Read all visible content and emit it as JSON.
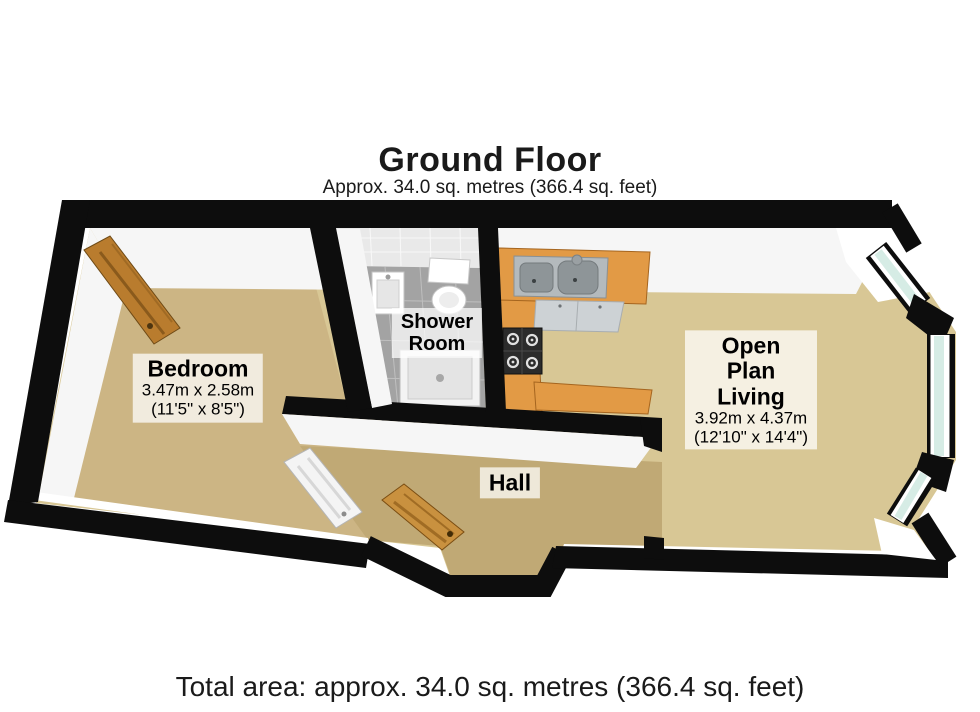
{
  "header": {
    "title": "Ground Floor",
    "subtitle": "Approx. 34.0 sq. metres (366.4 sq. feet)"
  },
  "footer": {
    "total_area": "Total area: approx. 34.0 sq. metres (366.4 sq. feet)"
  },
  "rooms": {
    "bedroom": {
      "name": "Bedroom",
      "metric": "3.47m x 2.58m",
      "imperial": "(11'5\" x 8'5\")"
    },
    "shower_room": {
      "line1": "Shower",
      "line2": "Room"
    },
    "hall": {
      "name": "Hall"
    },
    "open_plan_living": {
      "line1": "Open",
      "line2": "Plan",
      "line3": "Living",
      "metric": "3.92m x 4.37m",
      "imperial": "(12'10\" x 14'4\")"
    }
  },
  "colors": {
    "wall": "#0d0d0d",
    "floor_bedroom": "#ccb584",
    "floor_hall": "#c0a975",
    "floor_living": "#d8c795",
    "floor_shower": "#a3a3a3",
    "shower_wall_tile": "#e9e9e9",
    "counter": "#e29a45",
    "cabinet": "#cdd2d5",
    "sink_steel": "#b4babd",
    "basin": "#8e9598",
    "hob": "#2b2b2b",
    "glass": "#d6ece5",
    "door_wood": "#b97c2e",
    "front_door_wood": "#c9913f",
    "internal_door": "#f4f4f4"
  }
}
